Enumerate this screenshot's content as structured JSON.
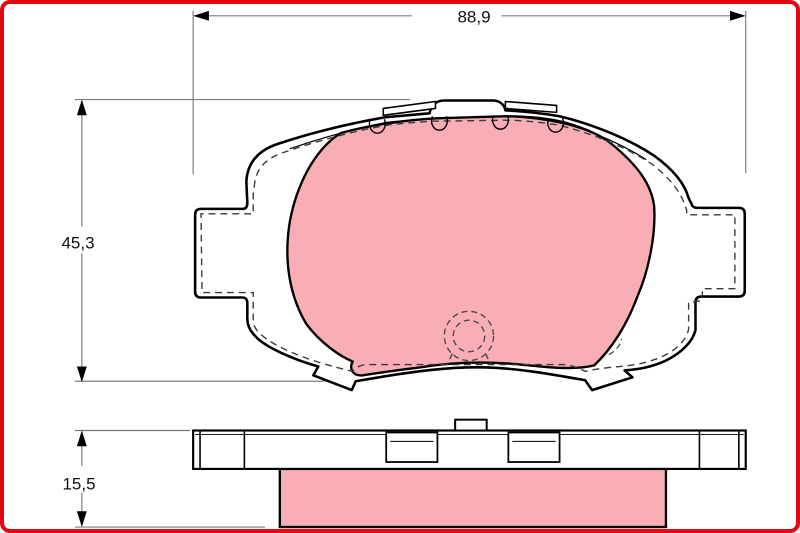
{
  "canvas": {
    "width": 800,
    "height": 533,
    "background": "#ffffff",
    "frame_color": "#e30613"
  },
  "drawing": {
    "subject": "disc-brake-pad-technical-drawing",
    "views": [
      "pad-rear-view-with-friction-material",
      "pad-edge-view"
    ],
    "colors": {
      "friction_material": "#f8aeb4",
      "outline": "#000000",
      "dimension_lines": "#7d7d7d",
      "text": "#111111"
    },
    "dimensions": {
      "width": {
        "label": "88,9",
        "orientation": "horizontal"
      },
      "height": {
        "label": "45,3",
        "orientation": "vertical"
      },
      "thickness": {
        "label": "15,5",
        "orientation": "vertical"
      }
    }
  }
}
